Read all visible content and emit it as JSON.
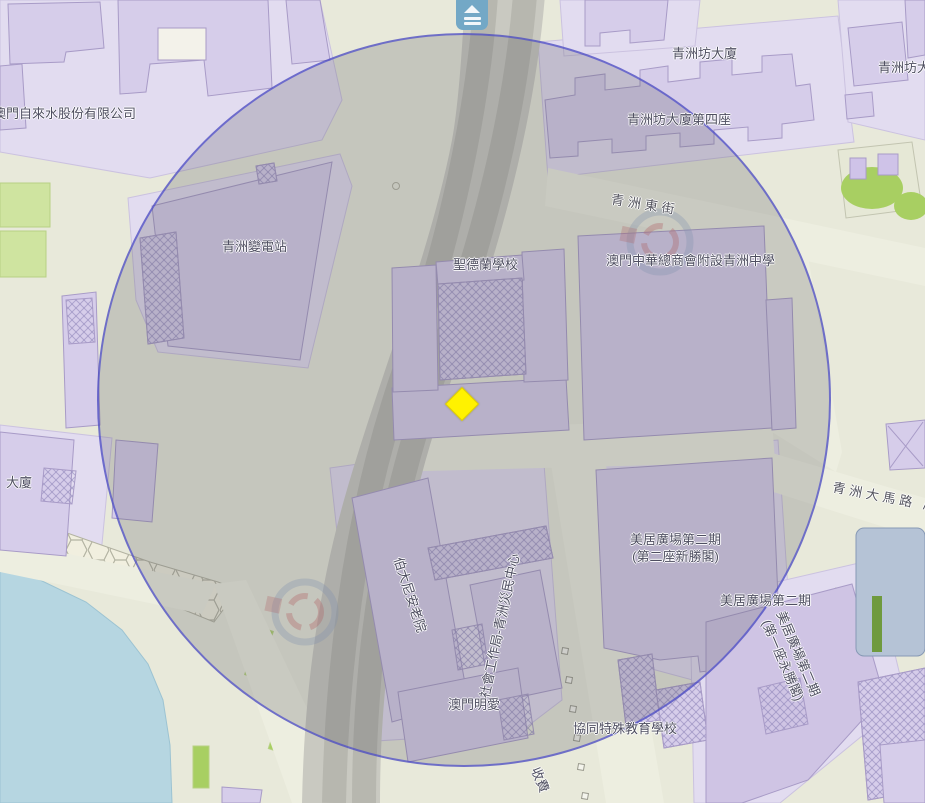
{
  "map": {
    "control": {
      "layers_button": "layers"
    },
    "overlay": {
      "circle_border_color": "#4848cc",
      "circle_fill": "rgba(88,88,97,0.24)"
    },
    "marker": {
      "shape": "diamond",
      "color": "#fff200"
    },
    "labels": {
      "water_company": "澳門自來水股份有限公司",
      "iec_block": "青洲坊大廈",
      "iec_block4": "青洲坊大廈第四座",
      "iec_corner": "青洲坊大廈",
      "substation": "青洲變電站",
      "st_theresa": "聖德蘭學校",
      "street_east": "青洲東街",
      "chung_wah_middle": "澳門中華總商會附設青洲中學",
      "building": "大廈",
      "avenida": "青洲大馬路 /",
      "mei_keng_a_l1": "美居廣場第二期",
      "mei_keng_a_l2": "(第二座新勝閣)",
      "mei_keng_b": "美居廣場第二期",
      "mei_keng_rot_l1": "美居廣場第二期",
      "mei_keng_rot_l2": "(第一座永勝閣)",
      "bethany": "伯大尼安老院",
      "relief_center": "社會工作局-青洲災民中心",
      "caritas": "澳門明愛",
      "concordia": "協同特殊教育學校",
      "toll": "收費"
    }
  }
}
